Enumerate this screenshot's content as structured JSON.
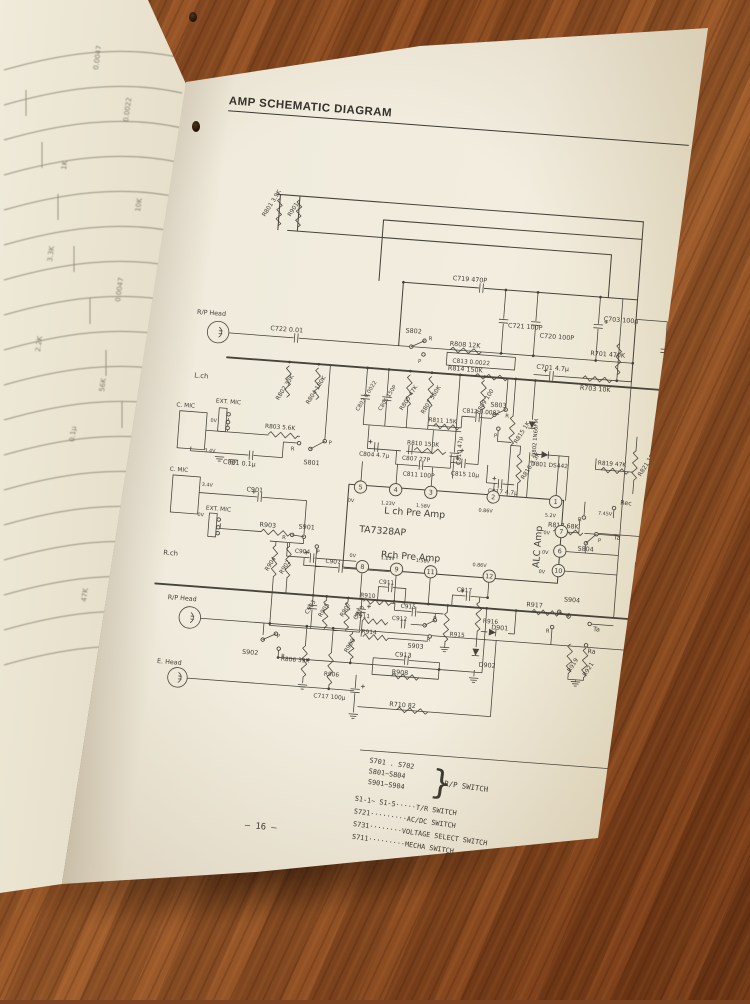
{
  "header": {
    "title": "AMP SCHEMATIC DIAGRAM"
  },
  "page_number": "– 16 –",
  "legend": {
    "group_items": [
      "S701 . S702",
      "S801~S804",
      "S901~S904"
    ],
    "brace": "}",
    "group_label": "R/P SWITCH",
    "rows": [
      "S1-1~ S1-5·····T/R SWITCH",
      "S721·········AC/DC SWITCH",
      "S731········VOLTAGE SELECT SWITCH",
      "S711·········MECHA SWITCH"
    ]
  },
  "schematic": {
    "ic": {
      "part": "TA7328AP",
      "pins": [
        {
          "n": "5",
          "v": "0V",
          "cx": 202,
          "cy": 332,
          "vx": 190,
          "vy": 348
        },
        {
          "n": "4",
          "v": "1.23V",
          "cx": 238,
          "cy": 332,
          "vx": 224,
          "vy": 348
        },
        {
          "n": "3",
          "v": "1.58V",
          "cx": 274,
          "cy": 332,
          "vx": 260,
          "vy": 348
        },
        {
          "n": "2",
          "v": "0.86V",
          "cx": 338,
          "cy": 332,
          "vx": 324,
          "vy": 348
        },
        {
          "n": "1",
          "v": "5.2V",
          "cx": 402,
          "cy": 332,
          "vx": 392,
          "vy": 348
        },
        {
          "n": "7",
          "v": "0V",
          "cx": 410,
          "cy": 362,
          "vx": 392,
          "vy": 366
        },
        {
          "n": "6",
          "v": "0V",
          "cx": 410,
          "cy": 382,
          "vx": 392,
          "vy": 386
        },
        {
          "n": "10",
          "v": "0V",
          "cx": 410,
          "cy": 402,
          "vx": 390,
          "vy": 406
        },
        {
          "n": "8",
          "v": "0V",
          "cx": 210,
          "cy": 413,
          "vx": 196,
          "vy": 404
        },
        {
          "n": "9",
          "v": "1.23V",
          "cx": 245,
          "cy": 413,
          "vx": 228,
          "vy": 404
        },
        {
          "n": "11",
          "v": "1.58V",
          "cx": 280,
          "cy": 413,
          "vx": 264,
          "vy": 404
        },
        {
          "n": "12",
          "v": "0.86V",
          "cx": 340,
          "cy": 413,
          "vx": 322,
          "vy": 404
        }
      ]
    },
    "labels": [
      {
        "t": "R801 3.9K",
        "x": 84,
        "y": 64,
        "r": -62,
        "s": 6
      },
      {
        "t": "R901",
        "x": 110,
        "y": 62,
        "r": -62,
        "s": 6
      },
      {
        "t": "C719 470P",
        "x": 280,
        "y": 114
      },
      {
        "t": "C721 100P",
        "x": 340,
        "y": 158
      },
      {
        "t": "C720 100P",
        "x": 373,
        "y": 166
      },
      {
        "t": "C703 100µ",
        "x": 437,
        "y": 144
      },
      {
        "t": "R701 470K",
        "x": 426,
        "y": 180
      },
      {
        "t": "C702 47µ",
        "x": 508,
        "y": 196,
        "r": -90
      },
      {
        "t": "C701 4.7µ",
        "x": 372,
        "y": 198
      },
      {
        "t": "R703 10K",
        "x": 418,
        "y": 216
      },
      {
        "t": "R/P Head",
        "x": 22,
        "y": 168
      },
      {
        "t": "C722 0.01",
        "x": 98,
        "y": 179
      },
      {
        "t": "S802",
        "x": 236,
        "y": 171
      },
      {
        "t": "R",
        "x": 260,
        "y": 177,
        "s": 5.5
      },
      {
        "t": "P",
        "x": 251,
        "y": 201,
        "s": 5.5
      },
      {
        "t": "R808 12K",
        "x": 282,
        "y": 181
      },
      {
        "t": "C813 0.0022",
        "x": 286,
        "y": 198,
        "s": 6
      },
      {
        "t": "L.ch",
        "x": 24,
        "y": 233,
        "s": 7
      },
      {
        "t": "R802 33K",
        "x": 112,
        "y": 250,
        "r": -62,
        "s": 6
      },
      {
        "t": "R804 180K",
        "x": 143,
        "y": 252,
        "r": -62,
        "s": 6
      },
      {
        "t": "C803 0.0022",
        "x": 194,
        "y": 255,
        "r": -62,
        "s": 5.5
      },
      {
        "t": "C805 150P",
        "x": 217,
        "y": 253,
        "r": -62,
        "s": 5.5
      },
      {
        "t": "R805 47K",
        "x": 239,
        "y": 251,
        "r": -62,
        "s": 6
      },
      {
        "t": "R807 560K",
        "x": 261,
        "y": 253,
        "r": -62,
        "s": 6
      },
      {
        "t": "R809 100",
        "x": 317,
        "y": 249,
        "r": -62,
        "s": 6
      },
      {
        "t": "R814 150K",
        "x": 282,
        "y": 206
      },
      {
        "t": "EXT. MIC",
        "x": 48,
        "y": 257,
        "s": 6
      },
      {
        "t": "R803 5.6K",
        "x": 100,
        "y": 279,
        "s": 6
      },
      {
        "t": "S801",
        "x": 142,
        "y": 313
      },
      {
        "t": "R",
        "x": 128,
        "y": 300,
        "s": 5.5
      },
      {
        "t": "P",
        "x": 166,
        "y": 291,
        "s": 5.5
      },
      {
        "t": "C801 0.1µ",
        "x": 60,
        "y": 319
      },
      {
        "t": "C. MIC",
        "x": 8,
        "y": 264,
        "s": 6
      },
      {
        "t": "0V",
        "x": 44,
        "y": 277,
        "s": 5
      },
      {
        "t": "3.4V",
        "x": 40,
        "y": 308,
        "s": 5
      },
      {
        "t": "C804 4.7µ",
        "x": 198,
        "y": 300,
        "s": 6
      },
      {
        "t": "C807 27P",
        "x": 242,
        "y": 301,
        "s": 6
      },
      {
        "t": "C810 47µ",
        "x": 302,
        "y": 302,
        "r": -90,
        "s": 6
      },
      {
        "t": "R810 150K",
        "x": 246,
        "y": 285,
        "s": 6
      },
      {
        "t": "R811 15K",
        "x": 266,
        "y": 260,
        "s": 6
      },
      {
        "t": "C812 0.0082",
        "x": 300,
        "y": 248,
        "s": 6
      },
      {
        "t": "S803",
        "x": 328,
        "y": 240
      },
      {
        "t": "R",
        "x": 344,
        "y": 250,
        "s": 5.5
      },
      {
        "t": "P",
        "x": 334,
        "y": 271,
        "s": 5.5
      },
      {
        "t": "R815 1K",
        "x": 358,
        "y": 276,
        "r": -62,
        "s": 6
      },
      {
        "t": "D802 1N60FM",
        "x": 378,
        "y": 288,
        "r": -90,
        "s": 5.5
      },
      {
        "t": "R816 3.3K",
        "x": 368,
        "y": 312,
        "r": -62,
        "s": 6
      },
      {
        "t": "C811 100P",
        "x": 244,
        "y": 317,
        "s": 6
      },
      {
        "t": "C815 10µ",
        "x": 293,
        "y": 313,
        "s": 6
      },
      {
        "t": "C817 4.7µ",
        "x": 332,
        "y": 328,
        "s": 6
      },
      {
        "t": "D801 DS442",
        "x": 374,
        "y": 297,
        "s": 6
      },
      {
        "t": "R817 68K",
        "x": 396,
        "y": 358
      },
      {
        "t": "R819 47K",
        "x": 442,
        "y": 291,
        "s": 6
      },
      {
        "t": "R821 18K",
        "x": 487,
        "y": 300,
        "r": -62,
        "s": 6
      },
      {
        "t": "Rec",
        "x": 468,
        "y": 330
      },
      {
        "t": "S804",
        "x": 428,
        "y": 380
      },
      {
        "t": "P",
        "x": 448,
        "y": 370,
        "s": 5.5
      },
      {
        "t": "R",
        "x": 426,
        "y": 350,
        "s": 5.5
      },
      {
        "t": "Ta",
        "x": 464,
        "y": 366
      },
      {
        "t": "7.45V",
        "x": 446,
        "y": 342,
        "s": 5
      },
      {
        "t": "Q7",
        "x": 497,
        "y": 360,
        "s": 7
      },
      {
        "t": "2SA",
        "x": 490,
        "y": 370,
        "s": 7
      },
      {
        "t": "R712",
        "x": 491,
        "y": 397,
        "s": 6
      },
      {
        "t": "R711",
        "x": 491,
        "y": 417,
        "s": 6
      },
      {
        "t": "L ch Pre Amp",
        "x": 228,
        "y": 357,
        "s": 9.5
      },
      {
        "t": "TA7328AP",
        "x": 204,
        "y": 378,
        "s": 9.5
      },
      {
        "t": "Rch Pre Amp",
        "x": 228,
        "y": 402,
        "s": 9.5
      },
      {
        "t": "ALC Amp",
        "x": 390,
        "y": 401,
        "r": -90,
        "s": 9.5
      },
      {
        "t": "C. MIC",
        "x": 6,
        "y": 330,
        "s": 6
      },
      {
        "t": "3.4V",
        "x": 40,
        "y": 343,
        "s": 5
      },
      {
        "t": "0V",
        "x": 38,
        "y": 374,
        "s": 5
      },
      {
        "t": "C901",
        "x": 86,
        "y": 345
      },
      {
        "t": "EXT. MIC",
        "x": 46,
        "y": 367,
        "s": 6
      },
      {
        "t": "R903",
        "x": 102,
        "y": 380
      },
      {
        "t": "S901",
        "x": 142,
        "y": 379
      },
      {
        "t": "R",
        "x": 126,
        "y": 391,
        "s": 5.5
      },
      {
        "t": "P",
        "x": 162,
        "y": 403,
        "s": 5.5
      },
      {
        "t": "R.ch",
        "x": 6,
        "y": 416,
        "s": 7
      },
      {
        "t": "R904",
        "x": 114,
        "y": 425,
        "r": -62,
        "s": 6
      },
      {
        "t": "R902",
        "x": 129,
        "y": 427,
        "r": -62,
        "s": 6
      },
      {
        "t": "C904",
        "x": 140,
        "y": 404,
        "s": 6
      },
      {
        "t": "C907",
        "x": 172,
        "y": 412,
        "s": 6
      },
      {
        "t": "C903",
        "x": 158,
        "y": 466,
        "r": -62,
        "s": 6
      },
      {
        "t": "R905",
        "x": 172,
        "y": 468,
        "r": -62,
        "s": 6
      },
      {
        "t": "R907",
        "x": 194,
        "y": 466,
        "r": -62,
        "s": 6
      },
      {
        "t": "C910",
        "x": 208,
        "y": 468,
        "r": -62,
        "s": 6
      },
      {
        "t": "R909",
        "x": 201,
        "y": 502,
        "r": -62,
        "s": 6
      },
      {
        "t": "C911",
        "x": 228,
        "y": 429,
        "s": 6
      },
      {
        "t": "R910",
        "x": 210,
        "y": 444,
        "s": 6
      },
      {
        "t": "C915",
        "x": 252,
        "y": 452,
        "s": 6
      },
      {
        "t": "C917",
        "x": 308,
        "y": 431,
        "s": 6
      },
      {
        "t": "R911",
        "x": 206,
        "y": 465,
        "s": 6
      },
      {
        "t": "C912",
        "x": 244,
        "y": 465,
        "s": 6
      },
      {
        "t": "P",
        "x": 286,
        "y": 462,
        "s": 5.5
      },
      {
        "t": "R",
        "x": 281,
        "y": 484,
        "s": 5.5
      },
      {
        "t": "S903",
        "x": 262,
        "y": 492
      },
      {
        "t": "R914",
        "x": 214,
        "y": 481,
        "s": 6
      },
      {
        "t": "R915",
        "x": 304,
        "y": 477,
        "s": 6
      },
      {
        "t": "R916",
        "x": 337,
        "y": 461,
        "s": 6
      },
      {
        "t": "D901",
        "x": 346,
        "y": 467
      },
      {
        "t": "D902",
        "x": 336,
        "y": 506
      },
      {
        "t": "R917",
        "x": 380,
        "y": 441
      },
      {
        "t": "S904",
        "x": 418,
        "y": 433
      },
      {
        "t": "P",
        "x": 412,
        "y": 448,
        "s": 5.5
      },
      {
        "t": "R",
        "x": 402,
        "y": 466,
        "s": 5.5
      },
      {
        "t": "Ta",
        "x": 450,
        "y": 461
      },
      {
        "t": "Ra",
        "x": 446,
        "y": 484
      },
      {
        "t": "R919",
        "x": 430,
        "y": 505,
        "r": -62,
        "s": 6
      },
      {
        "t": "R921",
        "x": 446,
        "y": 508,
        "r": -62,
        "s": 6
      },
      {
        "t": "R/P Head",
        "x": 14,
        "y": 461
      },
      {
        "t": "S902",
        "x": 94,
        "y": 511
      },
      {
        "t": "P",
        "x": 128,
        "y": 492,
        "s": 5.5
      },
      {
        "t": "R",
        "x": 134,
        "y": 512,
        "s": 5.5
      },
      {
        "t": "E. Head",
        "x": 8,
        "y": 527
      },
      {
        "t": "R806 39K",
        "x": 134,
        "y": 515,
        "s": 6
      },
      {
        "t": "R906",
        "x": 179,
        "y": 527,
        "s": 6
      },
      {
        "t": "C913",
        "x": 250,
        "y": 502
      },
      {
        "t": "R908",
        "x": 248,
        "y": 520
      },
      {
        "t": "C717 100µ",
        "x": 170,
        "y": 550,
        "s": 6
      },
      {
        "t": "R710 82",
        "x": 248,
        "y": 553
      }
    ]
  },
  "left_page": {
    "fragments": [
      {
        "t": "0.0047",
        "x": 98,
        "y": 70
      },
      {
        "t": "0.0022",
        "x": 128,
        "y": 122
      },
      {
        "t": "1K",
        "x": 66,
        "y": 170
      },
      {
        "t": "10K",
        "x": 140,
        "y": 212
      },
      {
        "t": "3.3K",
        "x": 52,
        "y": 262
      },
      {
        "t": "0.0047",
        "x": 120,
        "y": 302
      },
      {
        "t": "2.2K",
        "x": 40,
        "y": 352
      },
      {
        "t": "56K",
        "x": 104,
        "y": 392
      },
      {
        "t": "0.1µ",
        "x": 74,
        "y": 442
      },
      {
        "t": "50P",
        "x": 150,
        "y": 472
      },
      {
        "t": "LC 901 LA335",
        "x": 132,
        "y": 522
      },
      {
        "t": "47K",
        "x": 86,
        "y": 602
      }
    ]
  }
}
